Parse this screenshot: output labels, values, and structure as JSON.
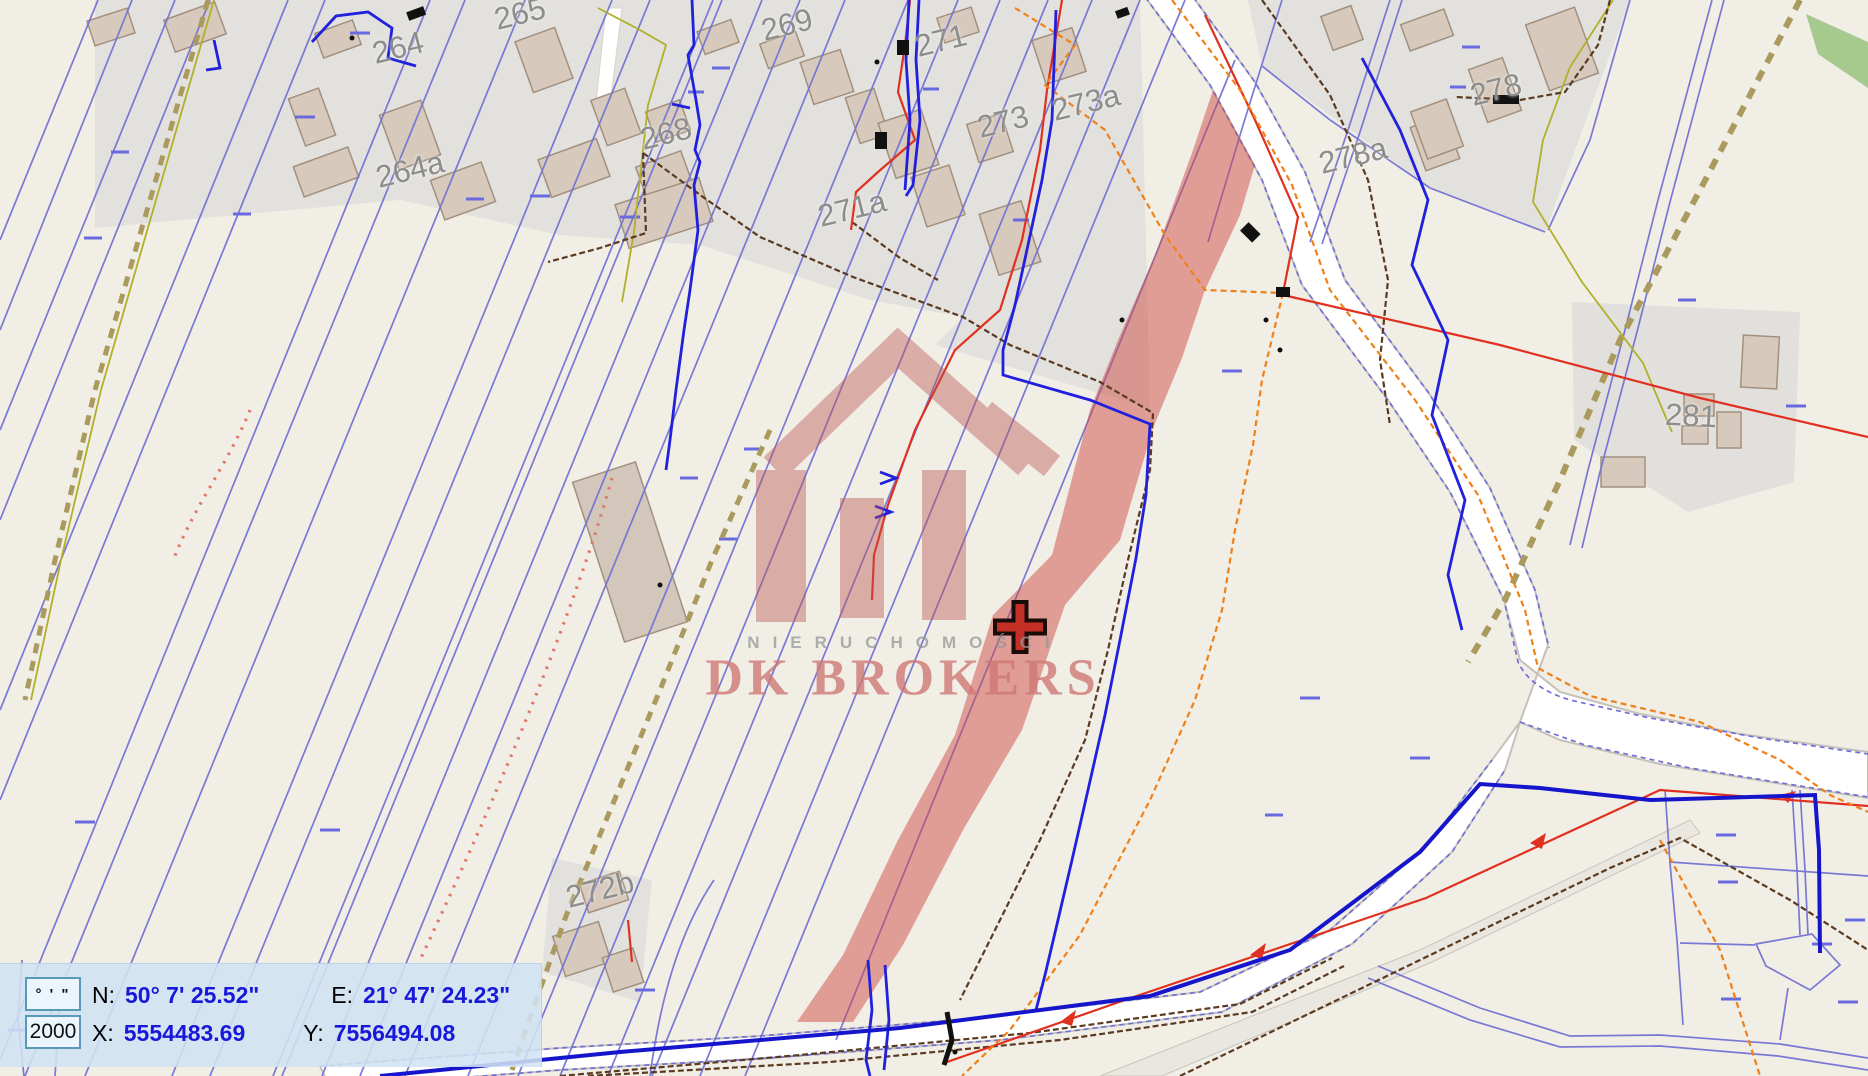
{
  "panel": {
    "dms_button": "° ' \"",
    "scale_value": "2000",
    "n_label": "N:",
    "n_value": "50° 7' 25.52\"",
    "e_label": "E:",
    "e_value": "21° 47' 24.23\"",
    "x_label": "X:",
    "x_value": "5554483.69",
    "y_label": "Y:",
    "y_value": "7556494.08"
  },
  "watermark": {
    "line1": "NIERUCHOMOŚCI",
    "line2": "DK BROKERS"
  },
  "map": {
    "selected_parcel_color": "#cd4b46",
    "parcel_line_color": "#7373d4",
    "background_color": "#f1eee6",
    "parcel_labels": [
      {
        "text": "264",
        "x": 398,
        "y": 48,
        "rot": -14
      },
      {
        "text": "264a",
        "x": 410,
        "y": 170,
        "rot": -14
      },
      {
        "text": "265",
        "x": 520,
        "y": 14,
        "rot": -14
      },
      {
        "text": "268",
        "x": 666,
        "y": 134,
        "rot": -14
      },
      {
        "text": "269",
        "x": 787,
        "y": 25,
        "rot": -14
      },
      {
        "text": "271",
        "x": 941,
        "y": 41,
        "rot": -14
      },
      {
        "text": "271a",
        "x": 852,
        "y": 209,
        "rot": -14
      },
      {
        "text": "273",
        "x": 1003,
        "y": 122,
        "rot": -14
      },
      {
        "text": "273a",
        "x": 1086,
        "y": 103,
        "rot": -14
      },
      {
        "text": "278",
        "x": 1496,
        "y": 90,
        "rot": -14
      },
      {
        "text": "278a",
        "x": 1353,
        "y": 156,
        "rot": -14
      },
      {
        "text": "281",
        "x": 1691,
        "y": 416,
        "rot": 3
      },
      {
        "text": "272b",
        "x": 600,
        "y": 890,
        "rot": -14
      }
    ]
  }
}
